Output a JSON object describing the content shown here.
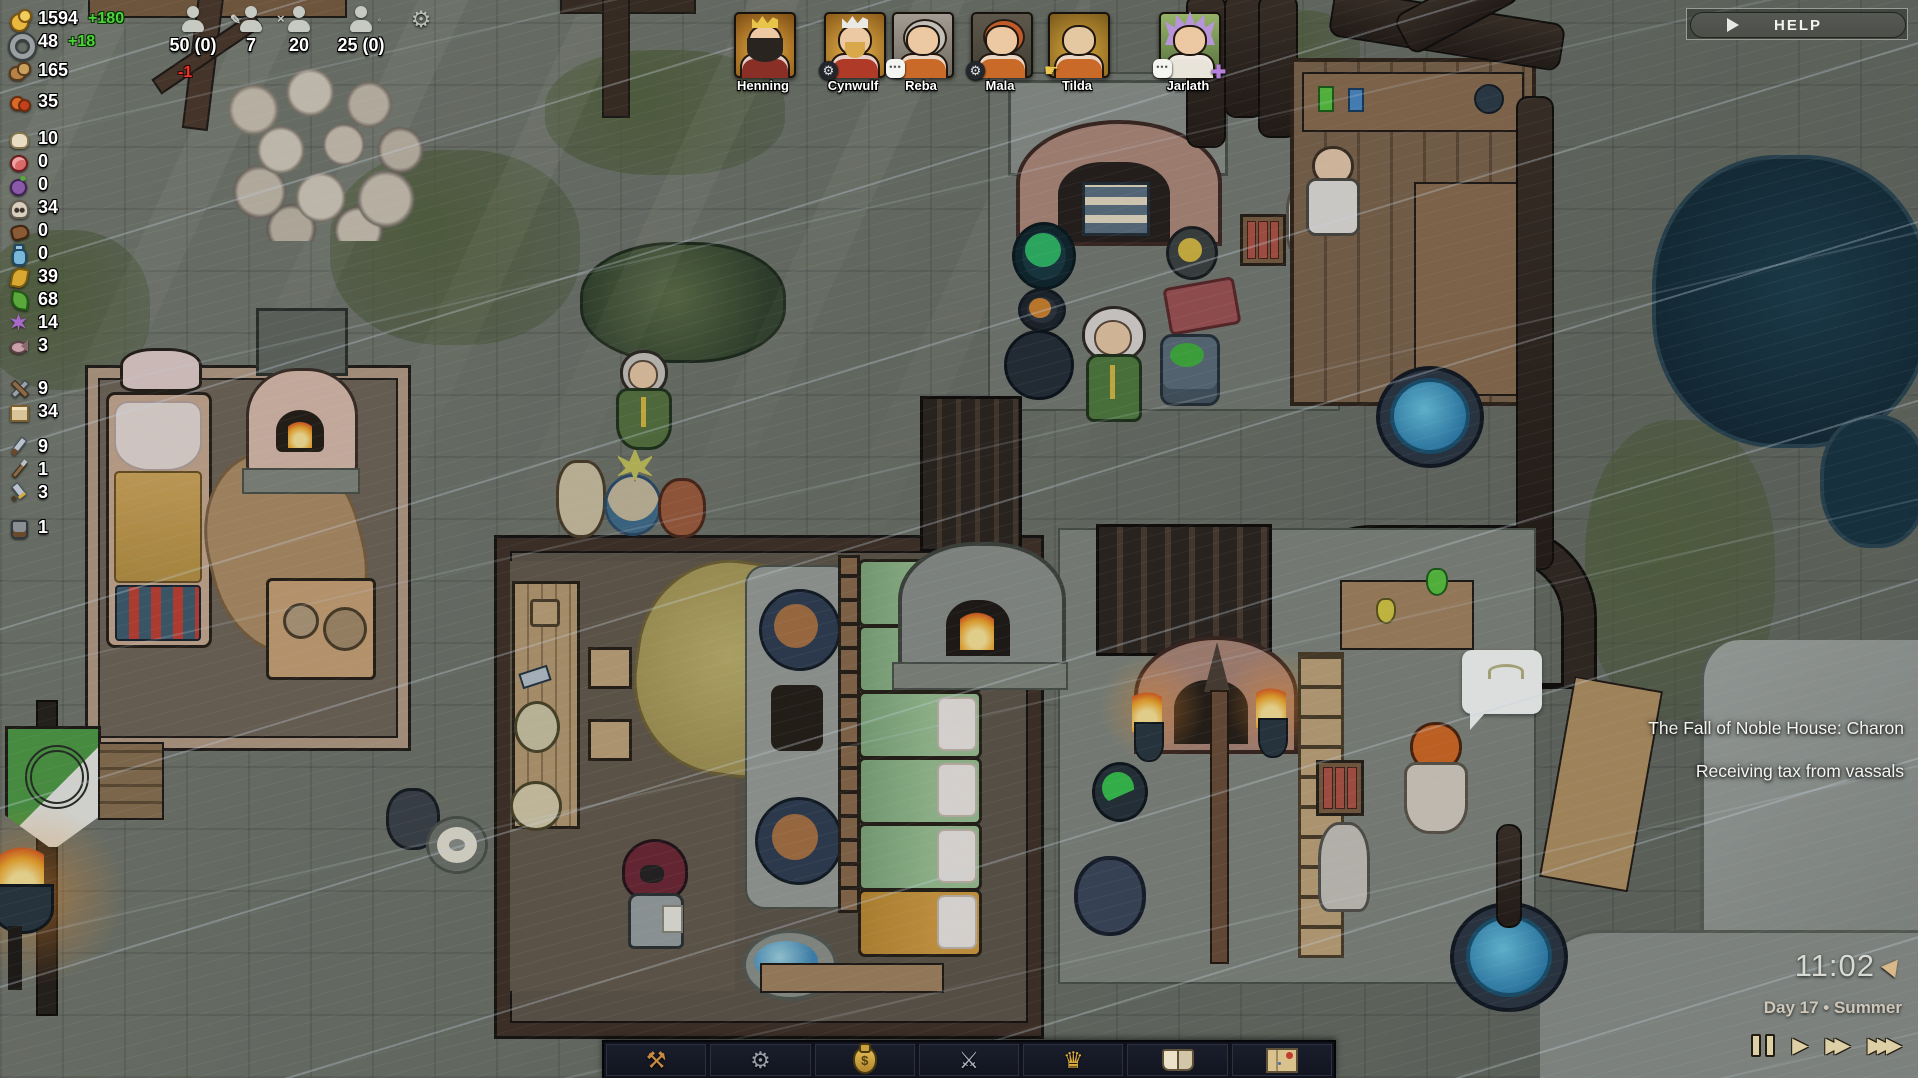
{
  "help": {
    "label": "HELP"
  },
  "resources": {
    "rows": [
      {
        "name": "gold",
        "icon": "gold-coins-icon",
        "value": "1594",
        "delta": "+180"
      },
      {
        "name": "iron",
        "icon": "iron-ring-icon",
        "value": "48",
        "delta": "+18"
      },
      {
        "name": "bread",
        "icon": "bread-icon",
        "value": "165"
      },
      {
        "name": "berries",
        "icon": "berries-icon",
        "value": "35"
      },
      {
        "name": "cheese",
        "icon": "cheese-icon",
        "value": "10"
      },
      {
        "name": "meat",
        "icon": "meat-icon",
        "value": "0"
      },
      {
        "name": "plums",
        "icon": "plums-icon",
        "value": "0"
      },
      {
        "name": "skulls",
        "icon": "skull-icon",
        "value": "34"
      },
      {
        "name": "leather",
        "icon": "leather-icon",
        "value": "0"
      },
      {
        "name": "potions",
        "icon": "potion-icon",
        "value": "0"
      },
      {
        "name": "wheat",
        "icon": "wheat-icon",
        "value": "39"
      },
      {
        "name": "herbs",
        "icon": "herb-leaf-icon",
        "value": "68"
      },
      {
        "name": "flowers",
        "icon": "flower-icon",
        "value": "14"
      },
      {
        "name": "fish",
        "icon": "fish-icon",
        "value": "3"
      },
      {
        "name": "tools",
        "icon": "tools-icon",
        "value": "9"
      },
      {
        "name": "parchment",
        "icon": "parchment-icon",
        "value": "34"
      },
      {
        "name": "daggers",
        "icon": "dagger-icon",
        "value": "9"
      },
      {
        "name": "spears",
        "icon": "spear-icon",
        "value": "1"
      },
      {
        "name": "swords",
        "icon": "sword-icon",
        "value": "3"
      },
      {
        "name": "armor",
        "icon": "armor-icon",
        "value": "1"
      }
    ]
  },
  "population": {
    "citizens": {
      "icon": "person-icon",
      "value": "50 (0)",
      "delta": "-1"
    },
    "workers": {
      "icon": "person-working-icon",
      "value": "7"
    },
    "idle": {
      "icon": "person-idle-icon",
      "value": "20"
    },
    "families": {
      "icon": "person-family-icon",
      "value": "25 (0)"
    }
  },
  "portraits": [
    {
      "name": "Henning",
      "badges": []
    },
    {
      "name": "Cynwulf",
      "badges": [
        "gear"
      ]
    },
    {
      "name": "Reba",
      "badges": [
        "speech"
      ]
    },
    {
      "name": "Mala",
      "badges": [
        "gear"
      ]
    },
    {
      "name": "Tilda",
      "badges": [
        "hand"
      ]
    },
    {
      "name": "Jarlath",
      "badges": [
        "speech",
        "cross"
      ]
    }
  ],
  "notifications": [
    "The Fall of Noble House: Charon",
    "Receiving tax from vassals"
  ],
  "clock": {
    "time": "11:02",
    "date": "Day 17 • Summer"
  },
  "toolbar": {
    "buttons": [
      "build",
      "production",
      "economy",
      "military",
      "kingdom",
      "knowledge",
      "world-map"
    ]
  },
  "colors": {
    "positive_delta": "#4fd13c",
    "negative_delta": "#e8392b",
    "water": "#2e9ec4",
    "banner_green": "#4d9a40",
    "flame": "#f4a928",
    "bed_blanket": "#9cc292",
    "toolbar_bg": "#10131c"
  }
}
